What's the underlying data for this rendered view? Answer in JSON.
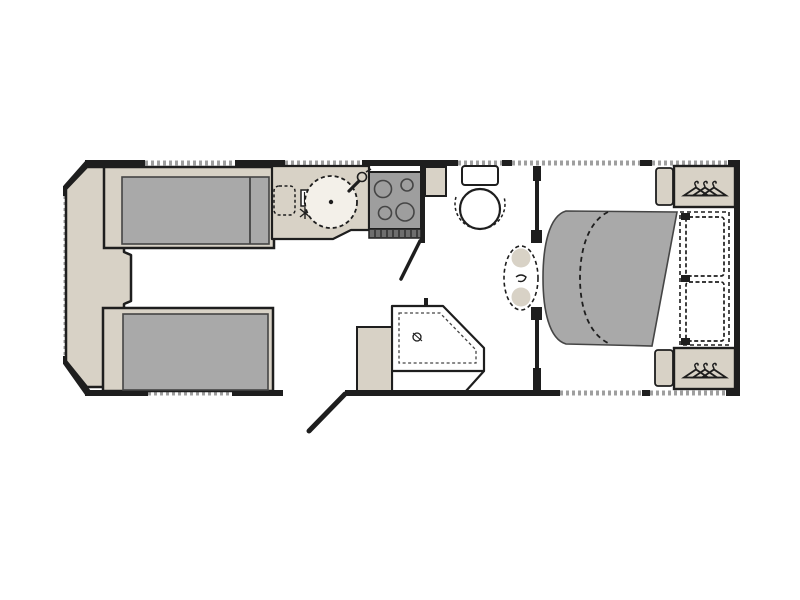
{
  "plan": {
    "type": "caravan-floorplan",
    "orientation": "front-left-rear-right",
    "rooms": [
      "front-lounge",
      "kitchen",
      "washroom",
      "shower-area",
      "rear-bedroom"
    ],
    "features": [
      "front chest with angled front wall windows",
      "two parallel lounge sofas with grey cushions",
      "kitchen worktop with round sink and tap",
      "plate drainer and control panel",
      "four-burner hob with grill vent",
      "overhead cupboard",
      "toilet with cistern",
      "fold-away washbasin",
      "corner shower tray with drain",
      "vanity cabinet",
      "open entrance door",
      "island bed with slide-out dashed outline",
      "two pillows",
      "two bedside cabinets",
      "two wardrobes with clothes hangers"
    ],
    "windows": {
      "top_wall": 5,
      "bottom_wall": 3,
      "front_wall": 1
    }
  },
  "icons": {
    "wardrobe": "clothes-hanger-icon",
    "sink": "round-sink-icon",
    "tap": "tap-icon",
    "hob": "four-burner-hob-icon",
    "toilet": "wc-icon",
    "basin": "scalloped-basin-icon",
    "shower": "corner-shower-icon",
    "drain": "drain-icon"
  },
  "palette": {
    "paper": "#ffffff",
    "floor": "#ffffff",
    "wall": "#1e1e1e",
    "outline": "#454545",
    "furniture": "#d8d2c6",
    "cushion": "#a9a9a9",
    "hob": "#9e9e9e",
    "vent": "#6e6e6e",
    "sink": "#f3f0e9",
    "window": "#9f9f9f"
  }
}
